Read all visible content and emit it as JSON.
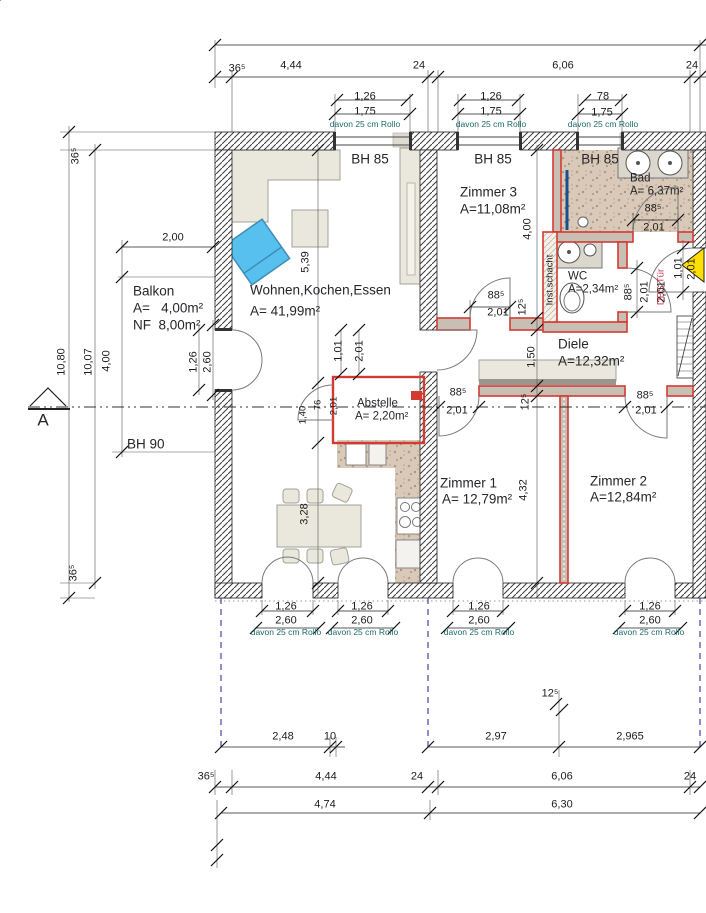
{
  "drawing": {
    "type": "Grundriss / floor plan",
    "section_mark": "A"
  },
  "colors": {
    "dim_text": "#1c1c1c",
    "rollo_text": "#1c6b6b",
    "partition_wall": "#d23b31",
    "entry_arrow": "#ffdf00",
    "armchair_blue": "#57c0ee",
    "balcony_guide": "#4545a0",
    "bath_floor": "#d8c9b8",
    "furniture": "#eae8dc"
  },
  "rooms": [
    {
      "name": "Wohnen,Kochen,Essen",
      "area": "A= 41,99m²",
      "sill": "BH 85"
    },
    {
      "name": "Zimmer 1",
      "area": "A= 12,79m²"
    },
    {
      "name": "Zimmer 2",
      "area": "A=12,84m²"
    },
    {
      "name": "Zimmer 3",
      "area": "A=11,08m²",
      "sill": "BH 85"
    },
    {
      "name": "Diele",
      "area": "A=12,32m²"
    },
    {
      "name": "Bad",
      "area": "A= 6,37m²",
      "sill": "BH 85"
    },
    {
      "name": "WC",
      "area": "A=2,34m²"
    },
    {
      "name": "Abstelle",
      "area": "A= 2,20m²"
    },
    {
      "name": "Balkon",
      "area": "A=   4,00m²",
      "nf": "NF  8,00m²",
      "sill": "BH 90"
    }
  ],
  "annotations": {
    "shaft": "Inst.schacht",
    "entry_door": "DBS Tür",
    "rollo_note": "davon 25 cm Rollo",
    "section": "A"
  },
  "labels": [
    {
      "t": "36⁵",
      "x": 237,
      "y": 69
    },
    {
      "t": "4,44",
      "x": 291,
      "y": 66
    },
    {
      "t": "24",
      "x": 419,
      "y": 66
    },
    {
      "t": "6,06",
      "x": 563,
      "y": 66
    },
    {
      "t": "24",
      "x": 692,
      "y": 66
    },
    {
      "t": "1,26",
      "x": 365,
      "y": 97
    },
    {
      "t": "1,75",
      "x": 365,
      "y": 112
    },
    {
      "t": "davon 25 cm Rollo",
      "x": 365,
      "y": 124,
      "c": "t"
    },
    {
      "t": "1,26",
      "x": 491,
      "y": 97
    },
    {
      "t": "1,75",
      "x": 491,
      "y": 112
    },
    {
      "t": "davon 25 cm Rollo",
      "x": 491,
      "y": 124,
      "c": "t"
    },
    {
      "t": "78",
      "x": 603,
      "y": 97
    },
    {
      "t": "1,75",
      "x": 602,
      "y": 113
    },
    {
      "t": "davon 25 cm Rollo",
      "x": 603,
      "y": 124,
      "c": "t"
    },
    {
      "t": "BH 85",
      "x": 370,
      "y": 159,
      "c": "bh",
      "n": "sill-label-wohnen"
    },
    {
      "t": "BH 85",
      "x": 493,
      "y": 159,
      "c": "bh",
      "n": "sill-label-zimmer3"
    },
    {
      "t": "BH 85",
      "x": 600,
      "y": 159,
      "c": "bh",
      "n": "sill-label-bad"
    },
    {
      "t": "Zimmer 3",
      "x": 460,
      "y": 192,
      "c": "rm la",
      "n": "room-label-zimmer-3"
    },
    {
      "t": "A=11,08m²",
      "x": 460,
      "y": 209,
      "c": "rm la"
    },
    {
      "t": "Bad",
      "x": 630,
      "y": 179,
      "c": "rs la",
      "n": "room-label-bad"
    },
    {
      "t": "A= 6,37m²",
      "x": 630,
      "y": 192,
      "c": "rs la"
    },
    {
      "t": "88⁵",
      "x": 653,
      "y": 209
    },
    {
      "t": "2,01",
      "x": 654,
      "y": 228
    },
    {
      "t": "Wohnen,Kochen,Essen",
      "x": 250,
      "y": 290,
      "c": "rm la",
      "n": "room-label-wohnen"
    },
    {
      "t": "A= 41,99m²",
      "x": 250,
      "y": 311,
      "c": "rm la"
    },
    {
      "t": "Balkon",
      "x": 133,
      "y": 291,
      "c": "rm la",
      "n": "room-label-balkon"
    },
    {
      "t": "A=   4,00m²",
      "x": 133,
      "y": 308,
      "c": "rm la"
    },
    {
      "t": "NF  8,00m²",
      "x": 133,
      "y": 325,
      "c": "rm la"
    },
    {
      "t": "2,00",
      "x": 173,
      "y": 238
    },
    {
      "t": "WC",
      "x": 568,
      "y": 277,
      "c": "rs la",
      "n": "room-label-wc"
    },
    {
      "t": "A=2,34m²",
      "x": 568,
      "y": 290,
      "c": "rs la"
    },
    {
      "t": "Inst.schacht",
      "x": 550,
      "y": 280,
      "r": 1,
      "c": "sm",
      "n": "shaft-label"
    },
    {
      "t": "DBS Tür",
      "x": 661,
      "y": 287,
      "r": 1,
      "c": "red",
      "n": "entry-door-label"
    },
    {
      "t": "Diele",
      "x": 558,
      "y": 344,
      "c": "rm la",
      "n": "room-label-diele"
    },
    {
      "t": "A=12,32m²",
      "x": 558,
      "y": 361,
      "c": "rm la"
    },
    {
      "t": "Abstelle",
      "x": 357,
      "y": 404,
      "c": "rs la",
      "n": "room-label-abstelle"
    },
    {
      "t": "A= 2,20m²",
      "x": 355,
      "y": 417,
      "c": "rs la"
    },
    {
      "t": "Zimmer 1",
      "x": 440,
      "y": 483,
      "c": "rm la",
      "n": "room-label-zimmer-1"
    },
    {
      "t": "A= 12,79m²",
      "x": 442,
      "y": 499,
      "c": "rm la"
    },
    {
      "t": "Zimmer 2",
      "x": 590,
      "y": 481,
      "c": "rm la",
      "n": "room-label-zimmer-2"
    },
    {
      "t": "A=12,84m²",
      "x": 590,
      "y": 497,
      "c": "rm la"
    },
    {
      "t": "BH 90",
      "x": 127,
      "y": 444,
      "c": "bh la",
      "n": "sill-label-balkon"
    },
    {
      "t": "A",
      "x": 43,
      "y": 420,
      "c": "big",
      "n": "section-letter"
    },
    {
      "t": "5,39",
      "x": 306,
      "y": 262,
      "r": 1
    },
    {
      "t": "3,28",
      "x": 305,
      "y": 514,
      "r": 1
    },
    {
      "t": "1,40",
      "x": 303,
      "y": 415,
      "r": 1,
      "c": "sm"
    },
    {
      "t": "76",
      "x": 318,
      "y": 405,
      "r": 1,
      "c": "sm"
    },
    {
      "t": "2,01",
      "x": 334,
      "y": 406,
      "r": 1,
      "c": "sm"
    },
    {
      "t": "1,01",
      "x": 339,
      "y": 351,
      "r": 1
    },
    {
      "t": "2,01",
      "x": 360,
      "y": 351,
      "r": 1
    },
    {
      "t": "1,26",
      "x": 194,
      "y": 362,
      "r": 1
    },
    {
      "t": "2,60",
      "x": 208,
      "y": 362,
      "r": 1
    },
    {
      "t": "10,80",
      "x": 62,
      "y": 362,
      "r": 1
    },
    {
      "t": "10,07",
      "x": 89,
      "y": 362,
      "r": 1
    },
    {
      "t": "4,00",
      "x": 107,
      "y": 361,
      "r": 1
    },
    {
      "t": "36⁵",
      "x": 76,
      "y": 156,
      "r": 1
    },
    {
      "t": "36⁵",
      "x": 74,
      "y": 573,
      "r": 1
    },
    {
      "t": "88⁵",
      "x": 496,
      "y": 296
    },
    {
      "t": "2,01",
      "x": 498,
      "y": 313
    },
    {
      "t": "4,00",
      "x": 528,
      "y": 229,
      "r": 1
    },
    {
      "t": "12⁵",
      "x": 523,
      "y": 307,
      "r": 1
    },
    {
      "t": "1,50",
      "x": 532,
      "y": 357,
      "r": 1
    },
    {
      "t": "12⁵",
      "x": 526,
      "y": 402,
      "r": 1
    },
    {
      "t": "4,32",
      "x": 524,
      "y": 490,
      "r": 1
    },
    {
      "t": "88⁵",
      "x": 458,
      "y": 393
    },
    {
      "t": "2,01",
      "x": 457,
      "y": 411
    },
    {
      "t": "88⁵",
      "x": 645,
      "y": 396
    },
    {
      "t": "2,01",
      "x": 646,
      "y": 411
    },
    {
      "t": "88⁵",
      "x": 629,
      "y": 292,
      "r": 1
    },
    {
      "t": "2,01",
      "x": 645,
      "y": 292,
      "r": 1
    },
    {
      "t": "2,01",
      "x": 662,
      "y": 292,
      "r": 1
    },
    {
      "t": "1,01",
      "x": 679,
      "y": 268,
      "r": 1
    },
    {
      "t": "2,01",
      "x": 692,
      "y": 269,
      "r": 1
    },
    {
      "t": "1,26",
      "x": 286,
      "y": 607
    },
    {
      "t": "2,60",
      "x": 286,
      "y": 621
    },
    {
      "t": "davon 25 cm Rollo",
      "x": 286,
      "y": 632,
      "c": "t"
    },
    {
      "t": "1,26",
      "x": 362,
      "y": 607
    },
    {
      "t": "2,60",
      "x": 362,
      "y": 621
    },
    {
      "t": "davon 25 cm Rollo",
      "x": 363,
      "y": 632,
      "c": "t"
    },
    {
      "t": "1,26",
      "x": 479,
      "y": 607
    },
    {
      "t": "2,60",
      "x": 479,
      "y": 621
    },
    {
      "t": "davon 25 cm Rollo",
      "x": 479,
      "y": 632,
      "c": "t"
    },
    {
      "t": "1,26",
      "x": 650,
      "y": 607
    },
    {
      "t": "2,60",
      "x": 650,
      "y": 621
    },
    {
      "t": "davon 25 cm Rollo",
      "x": 649,
      "y": 632,
      "c": "t"
    },
    {
      "t": "12⁵",
      "x": 550,
      "y": 694
    },
    {
      "t": "2,48",
      "x": 283,
      "y": 737
    },
    {
      "t": "10",
      "x": 330,
      "y": 737
    },
    {
      "t": "2,97",
      "x": 496,
      "y": 737
    },
    {
      "t": "2,965",
      "x": 630,
      "y": 737
    },
    {
      "t": "36⁵",
      "x": 206,
      "y": 777
    },
    {
      "t": "4,44",
      "x": 326,
      "y": 777
    },
    {
      "t": "24",
      "x": 417,
      "y": 777
    },
    {
      "t": "6,06",
      "x": 562,
      "y": 777
    },
    {
      "t": "24",
      "x": 690,
      "y": 777
    },
    {
      "t": "4,74",
      "x": 325,
      "y": 805
    },
    {
      "t": "6,30",
      "x": 562,
      "y": 805
    }
  ]
}
